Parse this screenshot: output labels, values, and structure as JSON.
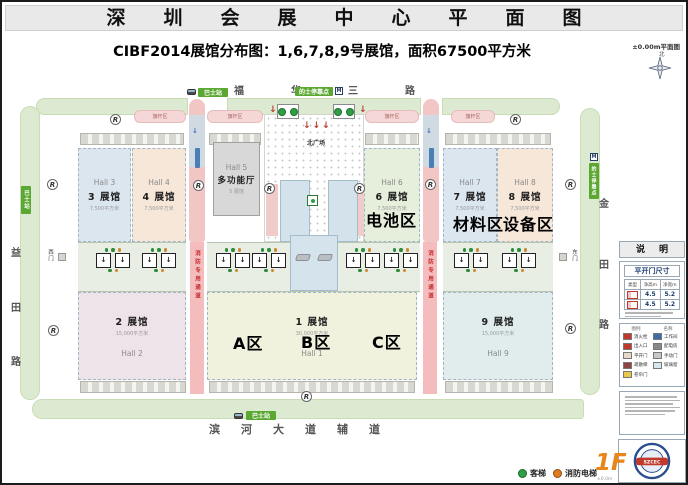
{
  "title": "深圳会展中心平面图",
  "subtitle": "CIBF2014展馆分布图：1,6,7,8,9号展馆，面积67500平方米",
  "plan_label": "±0.00m平面图",
  "compass": "北",
  "roads": {
    "top": "福华三路",
    "bottom": "滨河大道辅道",
    "left": [
      "益",
      "田",
      "路"
    ],
    "right": [
      "金",
      "田",
      "路"
    ]
  },
  "badges": {
    "bus": "巴士站",
    "taxi": "的士停靠点",
    "metro": "M"
  },
  "gates": {
    "west": "西门",
    "east": "东门"
  },
  "plan": {
    "plaza": "北广场",
    "fire_lane": "消防专用通道",
    "flag_area": "旗杆区"
  },
  "halls": {
    "h3": {
      "en": "Hall 3",
      "name": "3 展馆",
      "area": "7,500平方米",
      "color": "#dce6ef"
    },
    "h4": {
      "en": "Hall 4",
      "name": "4 展馆",
      "area": "7,500平方米",
      "color": "#f6e7d9"
    },
    "h5": {
      "en": "Hall 5",
      "name": "多功能厅",
      "sub": "5 展馆",
      "color": "#d8d8d8"
    },
    "h6": {
      "en": "Hall 6",
      "name": "6 展馆",
      "area": "7,500平方米",
      "color": "#e5efdc"
    },
    "h7": {
      "en": "Hall 7",
      "name": "7 展馆",
      "area": "7,500平方米",
      "color": "#dce6ef"
    },
    "h8": {
      "en": "Hall 8",
      "name": "8 展馆",
      "area": "7,500平方米",
      "color": "#f6e7d9"
    },
    "h2": {
      "en": "Hall 2",
      "name": "2 展馆",
      "area": "15,000平方米",
      "color": "#efe3ea"
    },
    "h1": {
      "en": "Hall 1",
      "name": "1 展馆",
      "area": "30,000平方米",
      "color": "#f0f2de"
    },
    "h9": {
      "en": "Hall 9",
      "name": "9 展馆",
      "area": "15,000平方米",
      "color": "#e1eded"
    }
  },
  "zones": {
    "battery": "电池区",
    "material": "材料区",
    "equipment": "设备区",
    "a": "A区",
    "b": "B区",
    "c": "C区"
  },
  "legend": {
    "header": "说明",
    "door": {
      "title": "平开门尺寸",
      "col_type": "类型",
      "col_h": "净高m",
      "col_w": "净宽m",
      "rows": [
        [
          "4.5",
          "5.2"
        ],
        [
          "4.5",
          "5.2"
        ]
      ]
    },
    "items_header": {
      "icon": "图例",
      "name": "名称"
    },
    "items_left": [
      {
        "label": "消火栓",
        "color": "#c0392b"
      },
      {
        "label": "出入口",
        "color": "#c0392b"
      },
      {
        "label": "平开门",
        "color": "#e8d8c8"
      },
      {
        "label": "疏散梯",
        "color": "#8e4444"
      },
      {
        "label": "卷帘门",
        "color": "#e8c84a"
      }
    ],
    "items_right": [
      {
        "label": "工作间",
        "color": "#3a6ea5"
      },
      {
        "label": "配电房",
        "color": "#888888"
      },
      {
        "label": "手动门",
        "color": "#c8c8c8"
      },
      {
        "label": "玻璃窗",
        "color": "#d5e6ee"
      }
    ]
  },
  "footer": {
    "passenger": "客梯",
    "fire_elevator": "消防电梯",
    "floor": "1F",
    "level": "±0.0m",
    "logo": "SZCEC"
  },
  "colors": {
    "road_green": "#dcead2",
    "badge_green": "#5aa832",
    "road_pink": "#f3c6c6",
    "fire_red": "#cc2a2a",
    "accent_orange": "#e8861a"
  }
}
